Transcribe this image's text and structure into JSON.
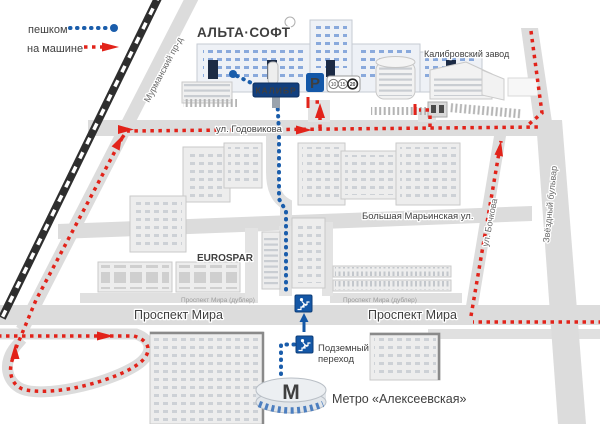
{
  "legend": {
    "walk": "пешком",
    "car": "на машине"
  },
  "logo": "АЛЬТА·СОФТ",
  "signs": {
    "kalibr": "КАЛИБР",
    "parking": "P",
    "zones": [
      "10",
      "15",
      "20"
    ],
    "metro_m": "М"
  },
  "streets": {
    "murmansky": "Мурманский пр-д",
    "godovikova": "ул. Годовикова",
    "marinskaya": "Большая Марьинская ул.",
    "bochkova": "ул. Бочкова",
    "zvezdny": "Звёздный бульвар",
    "prospekt_mira_left": "Проспект Мира",
    "prospekt_mira_right": "Проспект Мира",
    "dubler_left": "Проспект Мира (дублер)",
    "dubler_right": "Проспект Мира (дублер)"
  },
  "places": {
    "kalibrovsky_zavod": "Калибровский завод",
    "eurospar": "EUROSPAR",
    "underpass_line1": "Подземный",
    "underpass_line2": "переход",
    "metro_word": "Метро",
    "metro_station": "«Алексеевская»"
  },
  "colors": {
    "walk_route": "#1a5dab",
    "car_route": "#e2231a",
    "logo_blue": "#0a55a0",
    "sign_blue": "#1458a8",
    "accent_red": "#e2231a"
  }
}
